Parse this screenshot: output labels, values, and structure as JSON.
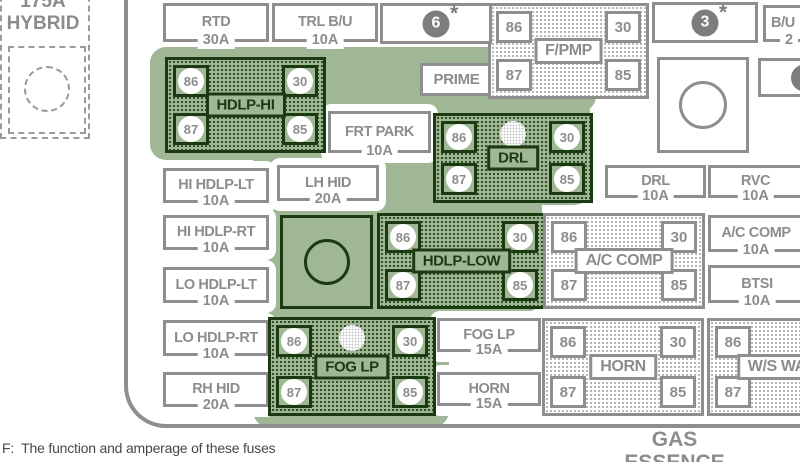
{
  "figure": {
    "type": "fuse-box-diagram"
  },
  "colors": {
    "highlight_green": "#a0b795",
    "dark_green": "#1b3a12",
    "line_gray": "#8e8e8e",
    "badge_gray": "#7d7d7d"
  },
  "hybrid_block": {
    "amp": "175A",
    "label": "HYBRID"
  },
  "prime_label": "PRIME",
  "fuses": [
    {
      "id": "rtd",
      "label": "RTD",
      "amp": "30A"
    },
    {
      "id": "trl-bu",
      "label": "TRL B/U",
      "amp": "10A"
    },
    {
      "id": "hi-hdlp-lt",
      "label": "HI HDLP-LT",
      "amp": "10A"
    },
    {
      "id": "hi-hdlp-rt",
      "label": "HI HDLP-RT",
      "amp": "10A"
    },
    {
      "id": "lo-hdlp-lt",
      "label": "LO HDLP-LT",
      "amp": "10A"
    },
    {
      "id": "lo-hdlp-rt",
      "label": "LO HDLP-RT",
      "amp": "10A"
    },
    {
      "id": "rh-hid",
      "label": "RH HID",
      "amp": "20A"
    },
    {
      "id": "frt-park",
      "label": "FRT PARK",
      "amp": "10A"
    },
    {
      "id": "lh-hid",
      "label": "LH HID",
      "amp": "20A"
    },
    {
      "id": "drl",
      "label": "DRL",
      "amp": "10A"
    },
    {
      "id": "rvc",
      "label": "RVC",
      "amp": "10A"
    },
    {
      "id": "ac-comp",
      "label": "A/C COMP",
      "amp": "10A"
    },
    {
      "id": "btsi",
      "label": "BTSI",
      "amp": "10A"
    },
    {
      "id": "fog-lp",
      "label": "FOG LP",
      "amp": "15A"
    },
    {
      "id": "horn",
      "label": "HORN",
      "amp": "15A"
    },
    {
      "id": "bu",
      "label": "B/U",
      "amp": "2"
    }
  ],
  "relays": [
    {
      "id": "hdlp-hi",
      "label": "HDLP-HI",
      "style": "green",
      "pins": {
        "tl": "86",
        "tr": "30",
        "bl": "87",
        "br": "85"
      }
    },
    {
      "id": "f-pmp",
      "label": "F/PMP",
      "style": "gray",
      "pins": {
        "tl": "86",
        "tr": "30",
        "bl": "87",
        "br": "85"
      }
    },
    {
      "id": "drl",
      "label": "DRL",
      "style": "green",
      "pins": {
        "tl": "86",
        "tr": "30",
        "bl": "87",
        "br": "85"
      }
    },
    {
      "id": "hdlp-low",
      "label": "HDLP-LOW",
      "style": "green",
      "pins": {
        "tl": "86",
        "tr": "30",
        "bl": "87",
        "br": "85"
      }
    },
    {
      "id": "ac-comp",
      "label": "A/C COMP",
      "style": "gray",
      "pins": {
        "tl": "86",
        "tr": "30",
        "bl": "87",
        "br": "85"
      }
    },
    {
      "id": "fog-lp",
      "label": "FOG LP",
      "style": "green",
      "pins": {
        "tl": "86",
        "tr": "30",
        "bl": "87",
        "br": "85"
      }
    },
    {
      "id": "horn",
      "label": "HORN",
      "style": "gray",
      "pins": {
        "tl": "86",
        "tr": "30",
        "bl": "87",
        "br": "85"
      }
    },
    {
      "id": "ws-wash",
      "label": "W/S WASH",
      "style": "gray",
      "pins": {
        "tl": "86",
        "tr": "30",
        "bl": "87",
        "br": "85"
      }
    }
  ],
  "badges": [
    {
      "id": "badge-6",
      "number": "6",
      "asterisk": "*"
    },
    {
      "id": "badge-3",
      "number": "3",
      "asterisk": "*"
    },
    {
      "id": "badge-partial",
      "number": "",
      "asterisk": ""
    }
  ],
  "bottom_caption": {
    "line1": "GAS",
    "line2": "ESSENCE"
  },
  "footnote": "F:  The function and amperage of these fuses"
}
